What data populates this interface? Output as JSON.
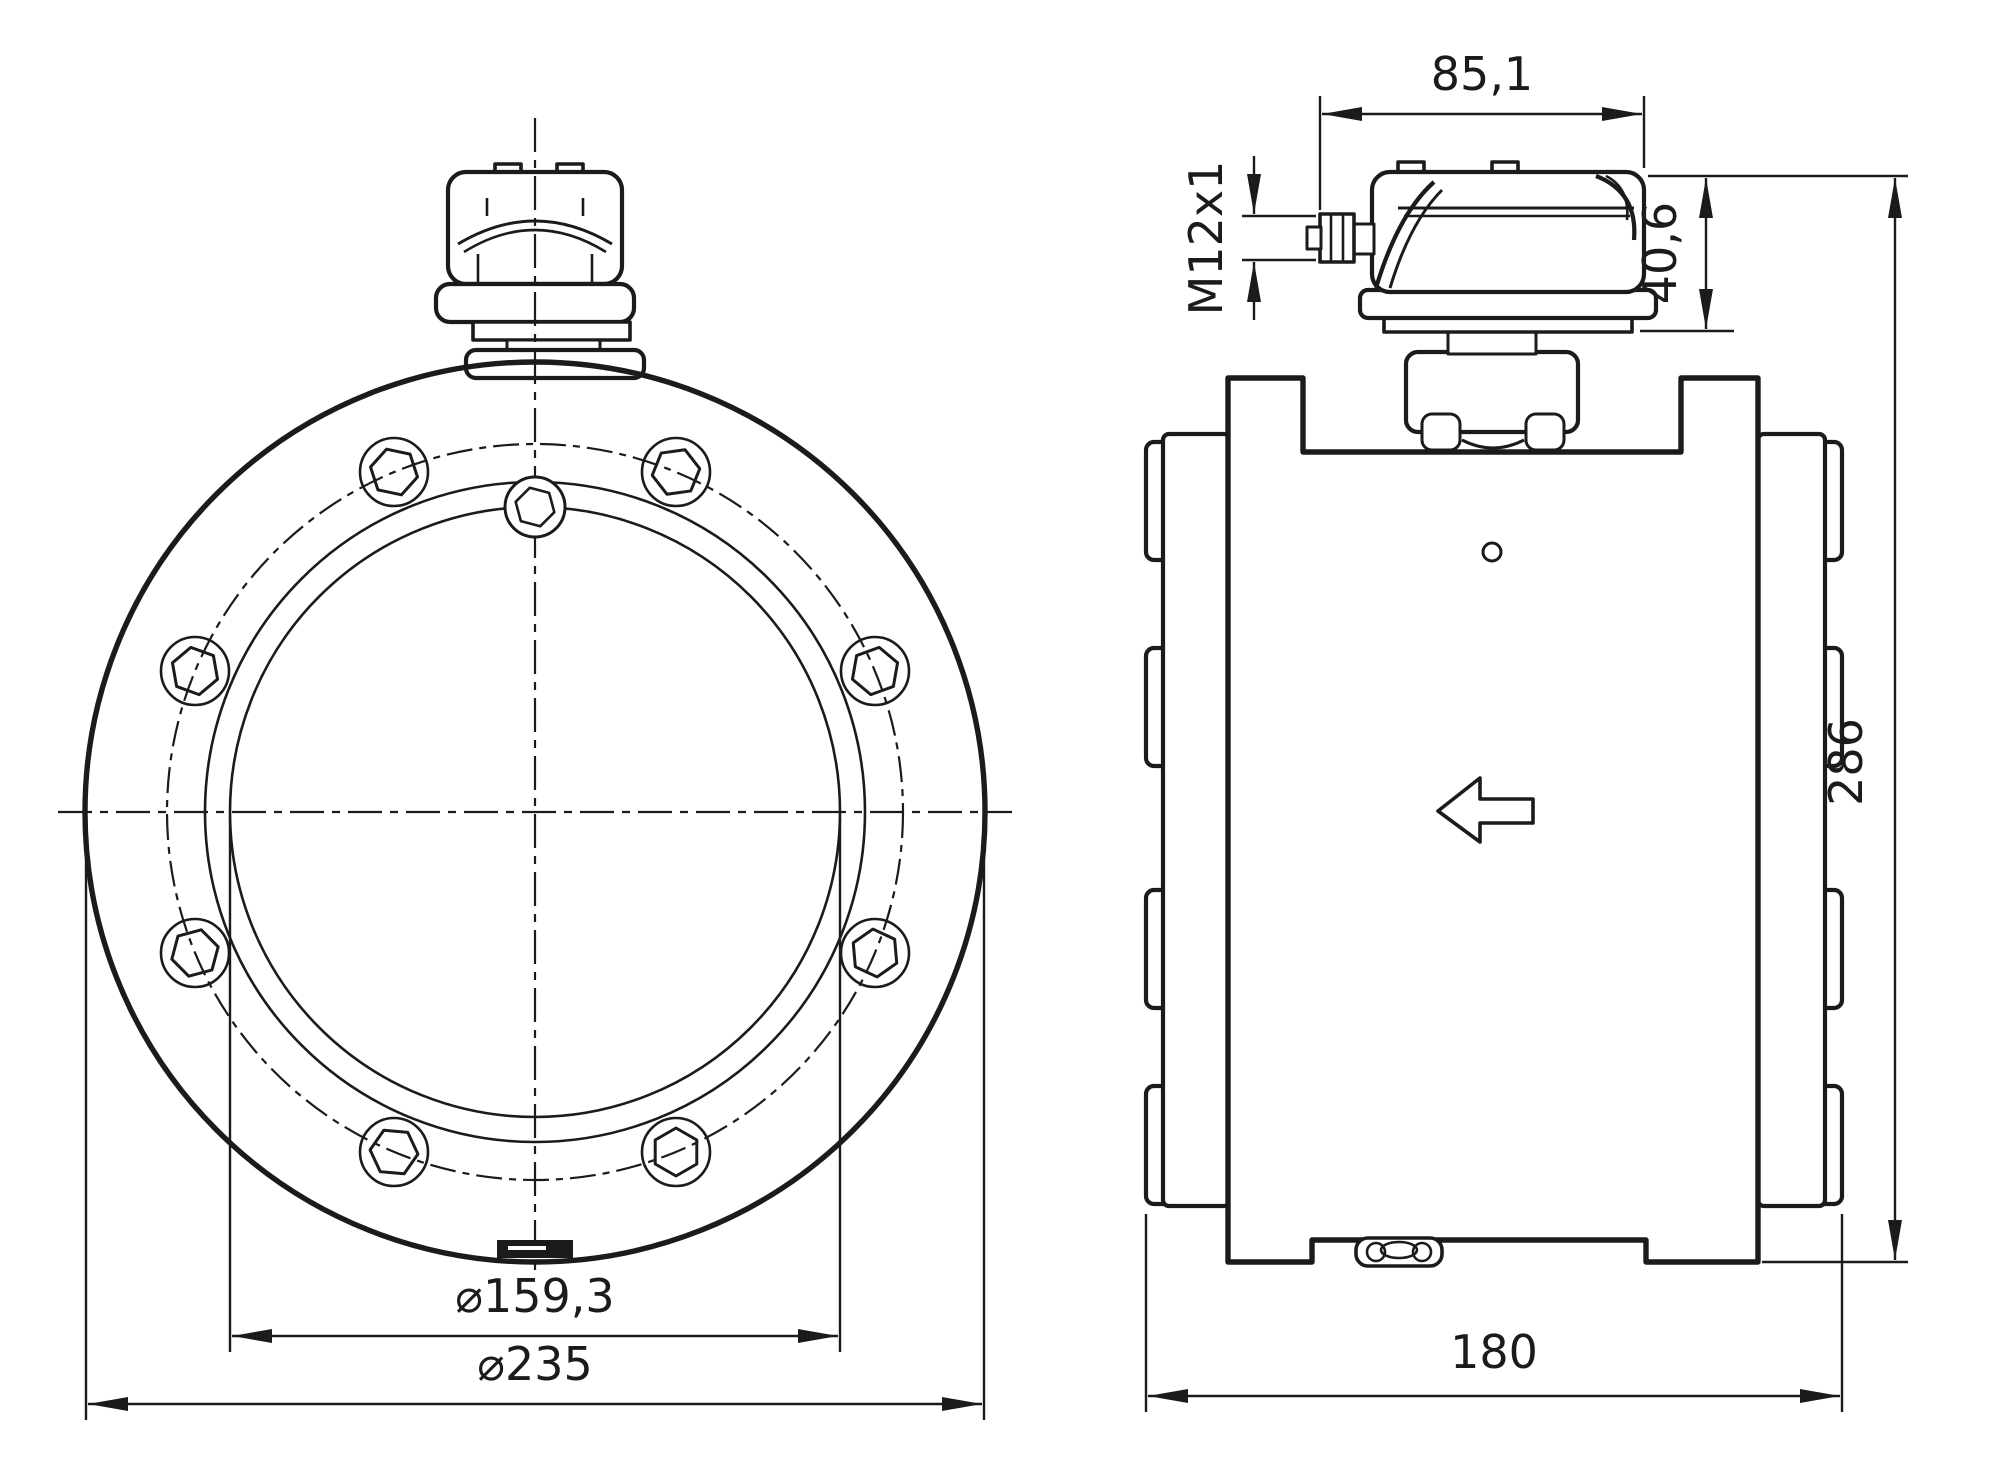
{
  "drawing": {
    "background": "#ffffff",
    "line_color": "#1b1b1b",
    "front_view": {
      "dim_bore_diameter": "⌀159,3",
      "dim_flange_outer_diameter": "⌀235"
    },
    "side_view": {
      "dim_head_width": "85,1",
      "dim_connector_thread": "M12x1",
      "dim_head_height": "40,6",
      "dim_total_height": "286",
      "dim_body_width": "180"
    }
  }
}
